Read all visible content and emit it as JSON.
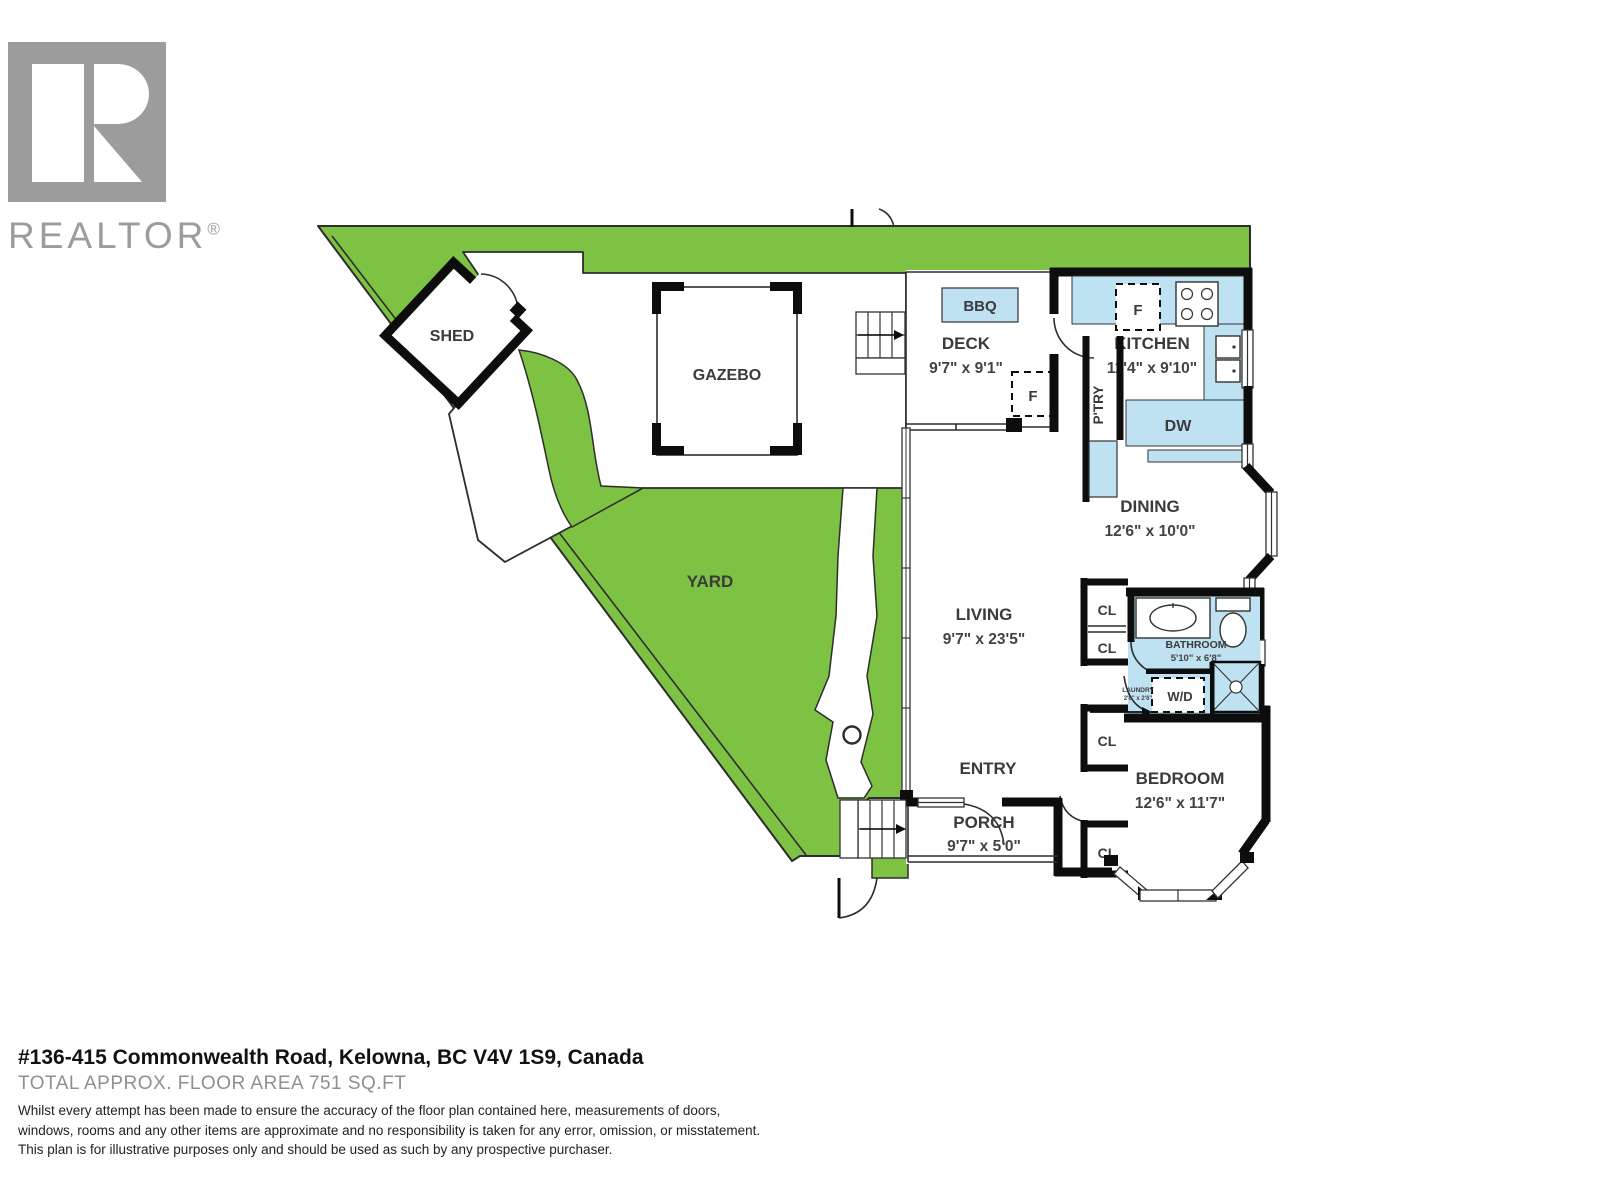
{
  "logo": {
    "brand": "REALTOR",
    "registered": "®"
  },
  "plan": {
    "outdoor": {
      "yard": "YARD",
      "shed": "SHED",
      "gazebo": "GAZEBO"
    },
    "deck": {
      "name": "DECK",
      "dims": "9'7\" x 9'1\"",
      "bbq": "BBQ",
      "fridge": "F"
    },
    "kitchen": {
      "name": "KITCHEN",
      "dims": "11'4\" x 9'10\"",
      "fridge": "F",
      "dishwasher": "DW",
      "pantry": "P'TRY"
    },
    "dining": {
      "name": "DINING",
      "dims": "12'6\" x 10'0\""
    },
    "living": {
      "name": "LIVING",
      "dims": "9'7\" x 23'5\""
    },
    "bathroom": {
      "name": "BATHROOM",
      "dims": "5'10\" x 6'8\""
    },
    "laundry": {
      "name": "LAUNDRY",
      "dims": "2'6\" x 2'6\"",
      "washer_dryer": "W/D"
    },
    "bedroom": {
      "name": "BEDROOM",
      "dims": "12'6\" x 11'7\""
    },
    "entry": {
      "name": "ENTRY"
    },
    "porch": {
      "name": "PORCH",
      "dims": "9'7\" x 5'0\""
    },
    "closet": "CL"
  },
  "footer": {
    "address": "#136-415 Commonwealth Road, Kelowna, BC V4V 1S9, Canada",
    "area": "TOTAL APPROX. FLOOR AREA 751 SQ.FT",
    "disclaimer": {
      "line1": "Whilst every attempt has been made to ensure the accuracy of the floor plan contained here, measurements of doors,",
      "line2": "windows, rooms and any other items are approximate and no responsibility is taken for any error, omission, or misstatement.",
      "line3": "This plan is for illustrative purposes only and should be used as such by any prospective purchaser."
    }
  },
  "colors": {
    "yard_green": "#7dc242",
    "fixture_blue": "#bfe2f3",
    "wall": "#0d0d0d",
    "logo_gray": "#9c9c9c"
  }
}
